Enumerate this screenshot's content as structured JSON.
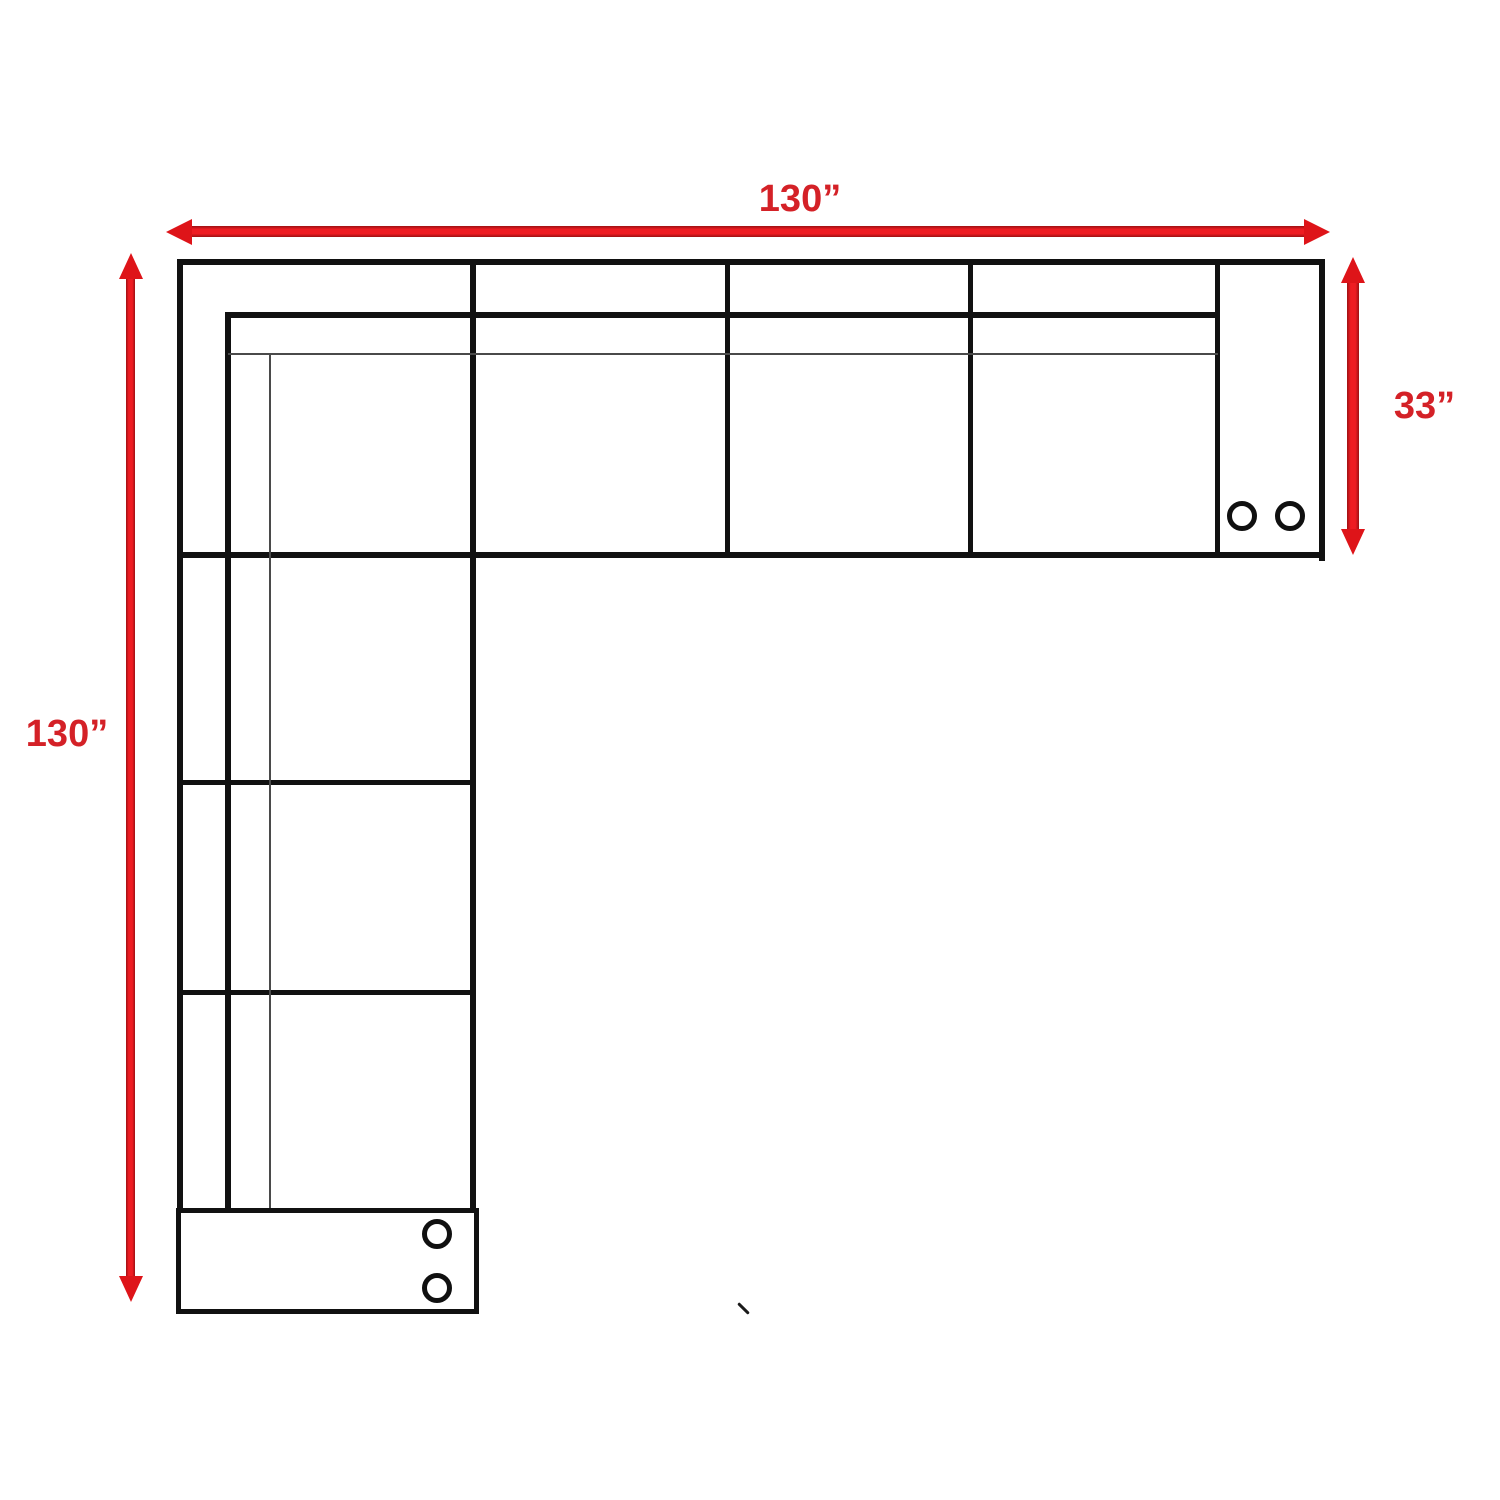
{
  "diagram": {
    "dimensions": {
      "top": {
        "label": "130”"
      },
      "left": {
        "label": "130”"
      },
      "right": {
        "label": "33”"
      }
    },
    "cupholders": {
      "right_console_count": 2,
      "bottom_console_count": 2,
      "icon": "cupholder-circle"
    },
    "colors": {
      "arrow_red": "#ee1c22",
      "label_red": "#d42127",
      "line_black": "#111111",
      "thin_line_gray": "#4a4a4a",
      "background": "#ffffff"
    }
  }
}
